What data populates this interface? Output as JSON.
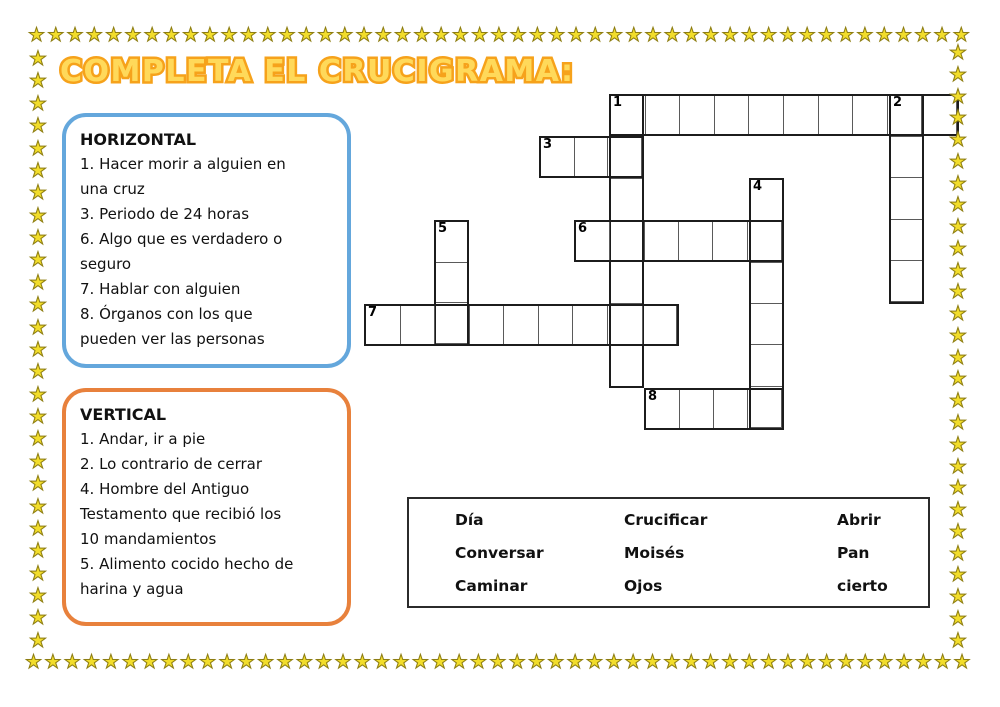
{
  "title": "COMPLETA EL CRUCIGRAMA:",
  "decoration": {
    "star_icon": "★",
    "star_fill": "#f2dd2b",
    "star_outline": "#8d7d12",
    "title_fill": "#ffd95a",
    "title_outline": "#f6a21b",
    "horizontal_box_border": "#64a7dc",
    "vertical_box_border": "#e8813c"
  },
  "horizontal_box": {
    "heading": "HORIZONTAL",
    "clues": [
      "1. Hacer morir a alguien en una cruz",
      "3. Periodo de 24 horas",
      "6. Algo que es verdadero o seguro",
      "7. Hablar con alguien",
      "8. Órganos con los que pueden ver las personas"
    ]
  },
  "vertical_box": {
    "heading": "VERTICAL",
    "clues": [
      "1. Andar, ir a pie",
      "2. Lo contrario de cerrar",
      "4. Hombre del Antiguo Testamento que recibió los 10 mandamientos",
      "5. Alimento cocido hecho de harina y agua"
    ]
  },
  "crossword": {
    "origin_x": 364,
    "origin_y": 94,
    "cell_width": 35,
    "cell_height": 42,
    "words": [
      {
        "label": "1",
        "dir": "across",
        "row": 0,
        "col": 7,
        "len": 10
      },
      {
        "label": "",
        "dir": "down",
        "row": 0,
        "col": 7,
        "len": 7
      },
      {
        "label": "2",
        "dir": "down",
        "row": 0,
        "col": 15,
        "len": 5
      },
      {
        "label": "3",
        "dir": "across",
        "row": 1,
        "col": 5,
        "len": 3
      },
      {
        "label": "4",
        "dir": "down",
        "row": 2,
        "col": 11,
        "len": 6
      },
      {
        "label": "5",
        "dir": "down",
        "row": 3,
        "col": 2,
        "len": 3
      },
      {
        "label": "6",
        "dir": "across",
        "row": 3,
        "col": 6,
        "len": 6
      },
      {
        "label": "7",
        "dir": "across",
        "row": 5,
        "col": 0,
        "len": 9
      },
      {
        "label": "8",
        "dir": "across",
        "row": 7,
        "col": 8,
        "len": 4
      }
    ]
  },
  "word_bank": {
    "rows": [
      [
        "Día",
        "Crucificar",
        "Abrir"
      ],
      [
        "Conversar",
        "Moisés",
        "Pan"
      ],
      [
        "Caminar",
        "Ojos",
        "cierto"
      ]
    ]
  }
}
